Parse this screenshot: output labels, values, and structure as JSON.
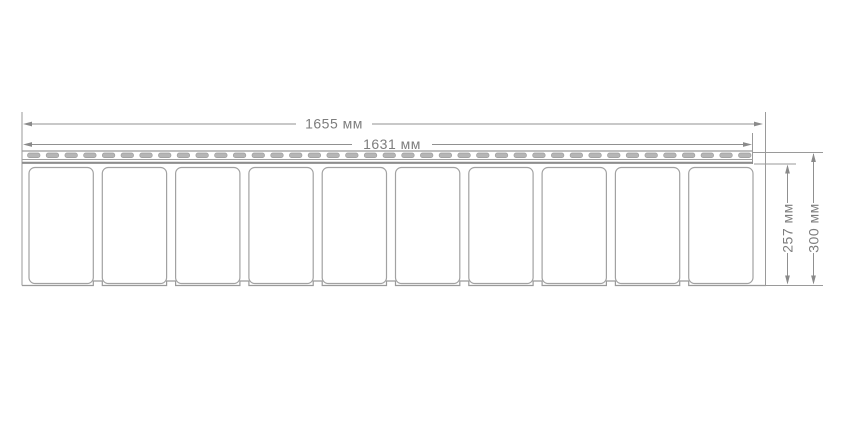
{
  "diagram": {
    "kind": "technical-dimension-drawing",
    "subject": "soffit-siding-panel",
    "units": "мм",
    "dimensions": {
      "overall_length": {
        "value": 1655,
        "label": "1655 мм"
      },
      "face_length": {
        "value": 1631,
        "label": "1631 мм"
      },
      "face_height": {
        "value": 257,
        "label": "257 мм"
      },
      "overall_height": {
        "value": 300,
        "label": "300 мм"
      }
    },
    "panel": {
      "lobe_count": 10,
      "nail_slot_count": 39
    },
    "colors": {
      "line": "#9a9a9a",
      "dimension_line": "#909090",
      "thick_line": "#8d8d8d",
      "text": "#7d7d7d",
      "slot_fill": "#b6b6b6",
      "slot_stroke": "#9d9d9d",
      "background": "#ffffff"
    }
  }
}
